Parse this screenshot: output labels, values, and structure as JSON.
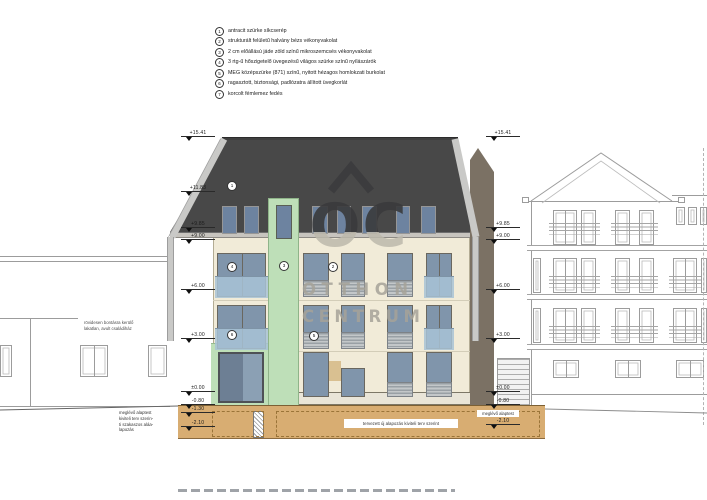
{
  "legend": {
    "items": [
      {
        "num": "1",
        "text": "antracit szürke síkcserép"
      },
      {
        "num": "2",
        "text": "strukturált felületű halvány bézs vékonyvakolat"
      },
      {
        "num": "3",
        "text": "2 cm előállású jáde zöld színű mikroszemcsés vékonyvakolat"
      },
      {
        "num": "4",
        "text": "3 rtg-ű hőszigetelő üvegezésű világos szürke színű nyílászárók"
      },
      {
        "num": "5",
        "text": "MEG középszürke (871) színű, nyitott hézagos homlokzati burkolat"
      },
      {
        "num": "6",
        "text": "ragasztott, biztonsági, padlózatra állított üvegkorlát"
      },
      {
        "num": "7",
        "text": "korcolt fémlemez fedés"
      }
    ]
  },
  "levels": {
    "left": [
      {
        "value": "+15.41"
      },
      {
        "value": "+11.83"
      },
      {
        "value": "+9.85"
      },
      {
        "value": "+9.00"
      },
      {
        "value": "+6.00"
      },
      {
        "value": "+3.00"
      },
      {
        "value": "±0.00"
      },
      {
        "value": "-0.80"
      },
      {
        "value": "-1.30"
      },
      {
        "value": "-2.10"
      }
    ],
    "right": [
      {
        "value": "+15.41"
      },
      {
        "value": "+9.85"
      },
      {
        "value": "+9.00"
      },
      {
        "value": "+6.00"
      },
      {
        "value": "+3.00"
      },
      {
        "value": "±0.00"
      },
      {
        "value": "-0.80"
      },
      {
        "value": "-2.10"
      }
    ]
  },
  "tags": {
    "roof": "1",
    "left_window": "4",
    "green_strip": "3",
    "facade": "2",
    "left_balcony": "6",
    "slats": "5"
  },
  "labels": {
    "left_neighbor_1": "rövidesen bontásra kerülő",
    "left_neighbor_2": "lakatlan, avult családiház",
    "existing_foundation_left": "meglévő alaptest",
    "underpinning_1": "kiviteli terv szerin-",
    "underpinning_2": "ti szakaszos aláa-",
    "underpinning_3": "lapozás",
    "existing_foundation_right": "meglévő alaptest",
    "new_foundation": "tervezett új alapozás kiviteli terv szerint"
  },
  "watermark": {
    "logo": "OC",
    "line1": "OTTHON",
    "line2": "CENTRUM"
  },
  "colors": {
    "roof": "#484848",
    "facade": "#f1ebd8",
    "green": "#bedfb8",
    "glass": "#8095ab",
    "foundation": "#d8ad72",
    "trim": "#c9c9c7",
    "outline": "#9c9c9c"
  }
}
